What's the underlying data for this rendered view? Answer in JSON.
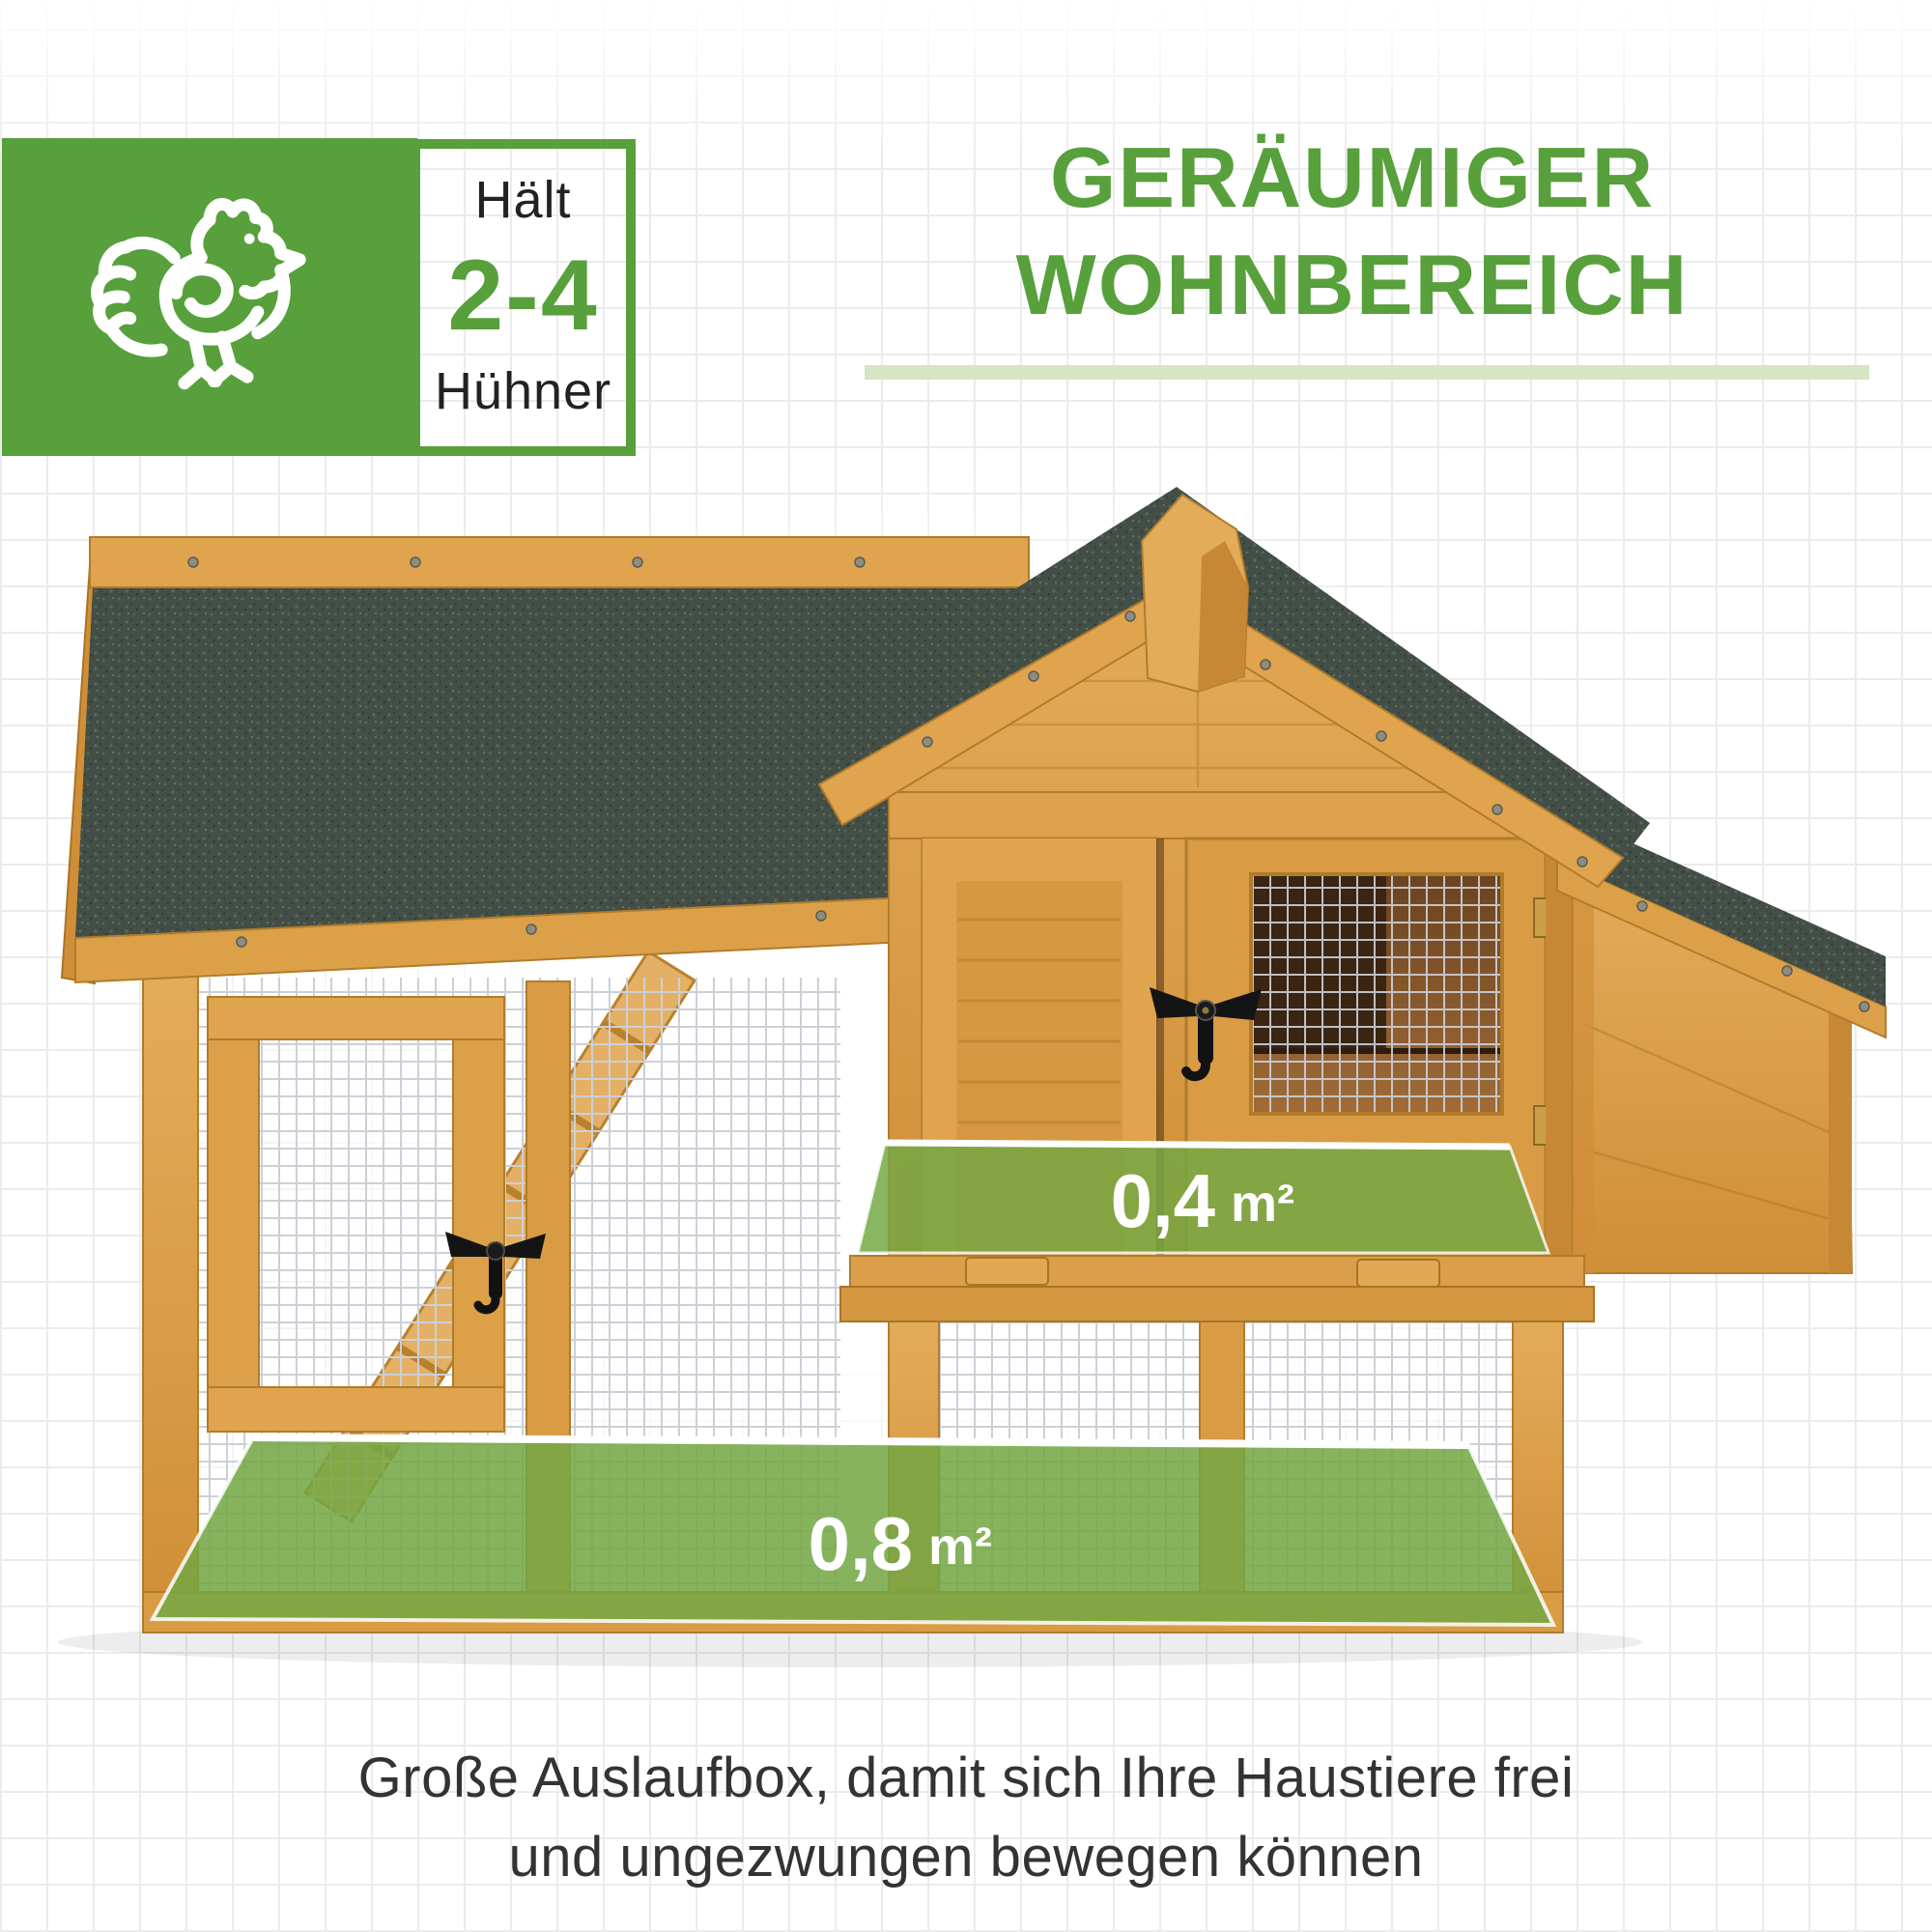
{
  "colors": {
    "accent_green": "#57A03C",
    "divider_green": "#D6E5C4",
    "overlay_green": "#74A743",
    "roof_green": "#434F46",
    "wood": "#DC9F4A",
    "text_dark": "#333333"
  },
  "badge": {
    "label_top": "Hält",
    "value": "2-4",
    "label_bottom": "Hühner",
    "icon": "chicken-outline-icon"
  },
  "heading": {
    "line1": "GERÄUMIGER",
    "line2": "WOHNBEREICH"
  },
  "area_labels": {
    "house": {
      "value": "0,4",
      "unit": "m²"
    },
    "run": {
      "value": "0,8",
      "unit": "m²"
    }
  },
  "caption": {
    "line1": "Große Auslaufbox, damit sich Ihre Haustiere frei",
    "line2": "und ungezwungen bewegen können"
  }
}
